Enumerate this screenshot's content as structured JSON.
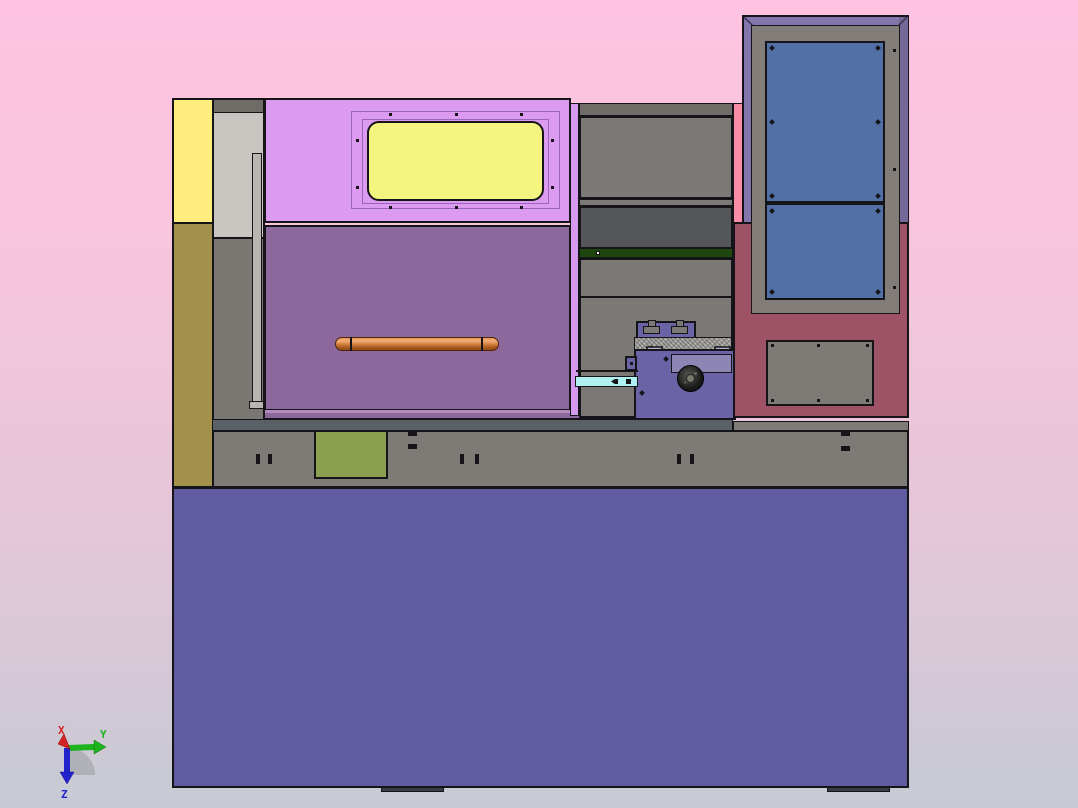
{
  "viewport": {
    "description": "3D CAD front view of a CNC lathe machine rendered on a pink gradient background"
  },
  "axis_triad": {
    "x_label": "X",
    "y_label": "Y",
    "z_label": "Z",
    "x_color": "#d42222",
    "y_color": "#1db31d",
    "z_color": "#2424cc",
    "arc_color": "#9a9aa0"
  },
  "colors": {
    "bg_top": "#ffc3e1",
    "bg_upper": "#f7c5dc",
    "bg_lower": "#e3c7d8",
    "bg_bottom": "#c6cad4",
    "outline": "#141419",
    "machine_base": "#615ba0",
    "foot": "#3c3c44",
    "yellow_panel": "#ffee7d",
    "olive_panel": "#a3914b",
    "column_dark": "#6f6b66",
    "column_light": "#c9c5c1",
    "column_warm": "#7b7772",
    "rail_gray": "#b9b5b1",
    "magenta_panel": "#dc9af0",
    "frame_line": "#9a66bb",
    "window_yellow": "#f4f481",
    "mauve_door": "#8d689c",
    "mauve_highlight": "#b28cc0",
    "violet_strip": "#d59aee",
    "mid_gray": "#7b7875",
    "charcoal_panel": "#54565a",
    "dark_green_strip": "#1d470f",
    "slate_turret": "#6a63a6",
    "slate_light": "#8d86b4",
    "clamp_lavender": "#b6b0ce",
    "texture_gray": "#9d9b97",
    "cyan_guide": "#b0f1f1",
    "pink_strip": "#fb8ca8",
    "maroon_panel": "#9d5266",
    "door_purple": "#8376ac",
    "door_purple_shade": "#746899",
    "door_frame_gray": "#837d79",
    "window_blue": "#5270a6",
    "plate_gray": "#7e7a76",
    "steel_strip": "#596066",
    "band_gray": "#7e7a75",
    "green_box": "#8ba04f",
    "handle_light": "#f2ae74",
    "handle_mid": "#cf7c3c",
    "handle_dark": "#8f4a12"
  }
}
